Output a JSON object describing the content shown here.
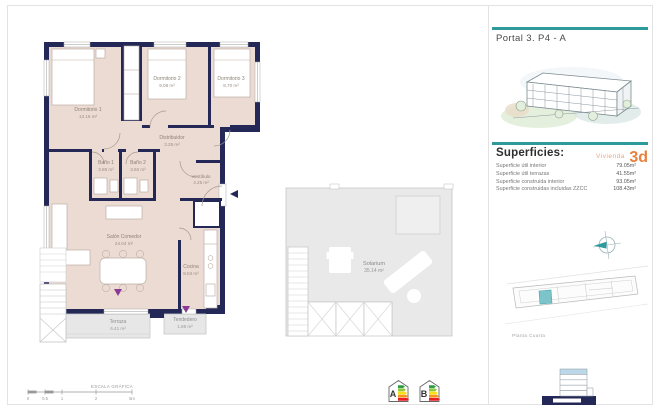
{
  "panel": {
    "title": "Portal 3. P4 - A",
    "superficies": {
      "heading": "Superficies:",
      "vivienda_label": "Vivienda",
      "vivienda_code": "3d",
      "rows": [
        {
          "label": "Superficie útil interior",
          "value": "79.05m²"
        },
        {
          "label": "Superficie útil terrazas",
          "value": "41.55m²"
        },
        {
          "label": "Superficie construida interior",
          "value": "93.05m²"
        },
        {
          "label": "Superficie construidas incluidas ZZCC",
          "value": "108.43m²"
        }
      ]
    },
    "siteplan_caption": "Planta Cuarta"
  },
  "floorplan": {
    "rooms": [
      {
        "name": "Dormitorio 1",
        "area": "13.16 m²"
      },
      {
        "name": "Dormitorio 2",
        "area": "9.08 m²"
      },
      {
        "name": "Dormitorio 3",
        "area": "8.70 m²"
      },
      {
        "name": "Distribuidor",
        "area": "3.25 m²"
      },
      {
        "name": "Baño 1",
        "area": "3.85 m²"
      },
      {
        "name": "Baño 2",
        "area": "3.60 m²"
      },
      {
        "name": "Vestíbulo",
        "area": "4.25 m²"
      },
      {
        "name": "Salón Comedor",
        "area": "24.04 m²"
      },
      {
        "name": "Cocina",
        "area": "8.04 m²"
      },
      {
        "name": "Terraza",
        "area": "6.41 m²"
      },
      {
        "name": "Tendedero",
        "area": "1.88 m²"
      }
    ]
  },
  "solarium": {
    "name": "Solarium",
    "area": "35.14 m²"
  },
  "scalebar": {
    "label": "ESCALA GRÁFICA",
    "ticks": [
      "0",
      "0.5",
      "1",
      "2",
      "5m"
    ]
  },
  "energy": {
    "labels": [
      "A",
      "B"
    ]
  },
  "colors": {
    "wall_navy": "#232857",
    "room_beige": "#ecdbd3",
    "terrace_gray": "#e7e7e7",
    "accent_teal": "#2e9a9c",
    "accent_orange": "#e8813f",
    "marker_purple": "#8b3a94"
  }
}
